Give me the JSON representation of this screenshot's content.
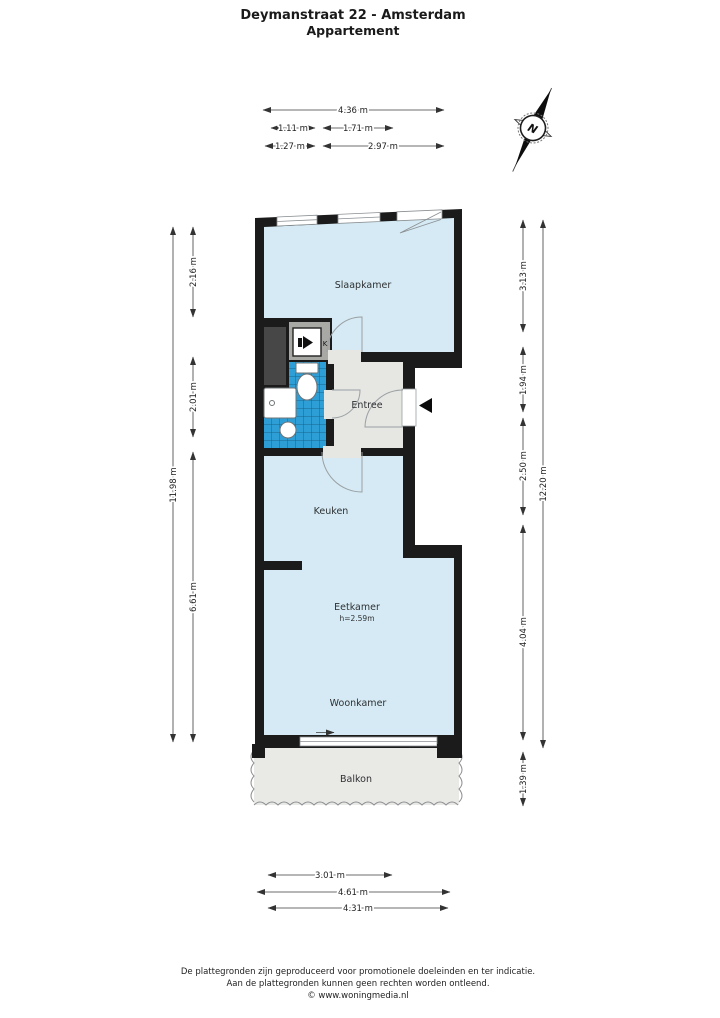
{
  "header": {
    "title": "Deymanstraat 22 - Amsterdam",
    "subtitle": "Appartement"
  },
  "compass": {
    "north_label": "N"
  },
  "rooms": {
    "slaapkamer": {
      "label": "Slaapkamer"
    },
    "entree": {
      "label": "Entree"
    },
    "keuken": {
      "label": "Keuken"
    },
    "eetkamer": {
      "label": "Eetkamer",
      "height_note": "h=2.59m"
    },
    "woonkamer": {
      "label": "Woonkamer"
    },
    "balkon": {
      "label": "Balkon"
    },
    "kast": {
      "label": "K"
    }
  },
  "dimensions": {
    "top": [
      "4.36 m",
      "1.11 m",
      "1.71 m",
      "1.27 m",
      "2.97 m"
    ],
    "left": [
      "11.98 m",
      "2.16 m",
      "2.01 m",
      "6.61 m"
    ],
    "right": [
      "3.13 m",
      "1.94 m",
      "2.50 m",
      "4.04 m",
      "1.39 m",
      "12.20 m"
    ],
    "bottom": [
      "3.01 m",
      "4.61 m",
      "4.31 m"
    ]
  },
  "footer": {
    "line1": "De plattegronden zijn geproduceerd voor promotionele doeleinden en ter indicatie.",
    "line2": "Aan de plattegronden kunnen geen rechten worden ontleend.",
    "line3": "© www.woningmedia.nl"
  },
  "colors": {
    "wall": "#1b1b1b",
    "room_fill": "#d5eaf4",
    "hall_fill": "#e6e6e3",
    "balkon_fill": "#e9e9e6",
    "shaft_fill": "#474747",
    "closet_fill": "#a8a8a5",
    "tile_blue": "#2e9fd6"
  }
}
